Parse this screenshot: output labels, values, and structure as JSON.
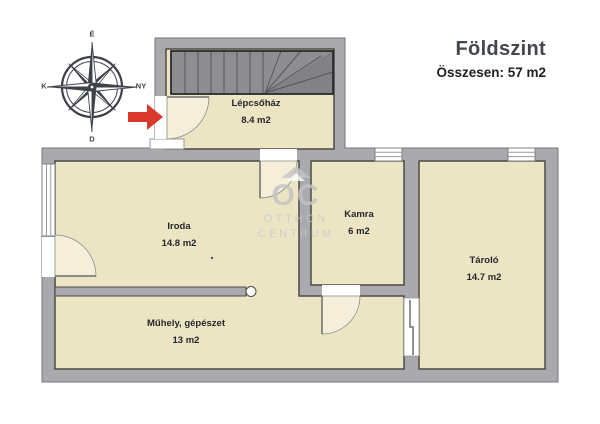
{
  "header": {
    "title": "Földszint",
    "subtitle": "Összesen: 57 m2"
  },
  "compass": {
    "top": "É",
    "right": "NY",
    "bottom": "D",
    "left": "K"
  },
  "rooms": {
    "lepcsohaz": {
      "name": "Lépcsőház",
      "area": "8.4 m2"
    },
    "iroda": {
      "name": "Iroda",
      "area": "14.8 m2"
    },
    "kamra": {
      "name": "Kamra",
      "area": "6 m2"
    },
    "tarolo": {
      "name": "Tároló",
      "area": "14.7 m2"
    },
    "muhely": {
      "name": "Műhely, gépészet",
      "area": "13 m2"
    }
  },
  "watermark": {
    "brand": "OC",
    "line1": "OTTHON",
    "line2": "CENTRUM"
  },
  "colors": {
    "wall_gray": "#a9a9ae",
    "room_fill": "#ece5c4",
    "door_swing_fill": "#f4eeda",
    "stairs_gray": "#8e8d92",
    "outline_dark": "#4b4b46",
    "arrow_red": "#d8392c",
    "title_text": "#43464b",
    "label_text": "#26262a",
    "compass_ink": "#3e4148",
    "watermark_gray": "#c2c2c2"
  }
}
